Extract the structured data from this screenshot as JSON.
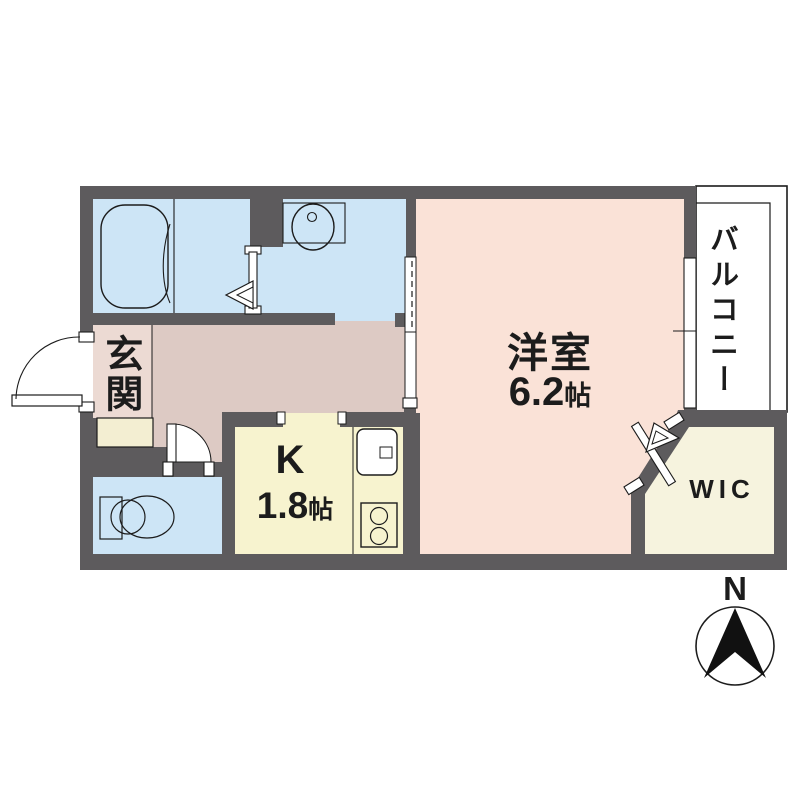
{
  "plan": {
    "rooms": {
      "genkan": {
        "label": "玄関"
      },
      "western_room": {
        "label": "洋室",
        "size_number": "6.2",
        "size_unit": "帖"
      },
      "kitchen": {
        "label": "K",
        "size_number": "1.8",
        "size_unit": "帖"
      },
      "wic": {
        "label": "WIC"
      },
      "balcony": {
        "label": "バルコニー"
      }
    },
    "compass": {
      "north_label": "N"
    }
  },
  "colors": {
    "wall": "#5d5b5d",
    "outline": "#1c1c1c",
    "water": "#cde5f6",
    "hallway": "#ddcac4",
    "genkan": "#ecdad3",
    "western": "#fae2d7",
    "kitchen": "#f7f3cf",
    "wic": "#f6f3de",
    "cabinet": "#f3eed2",
    "white": "#ffffff",
    "black": "#111111"
  }
}
